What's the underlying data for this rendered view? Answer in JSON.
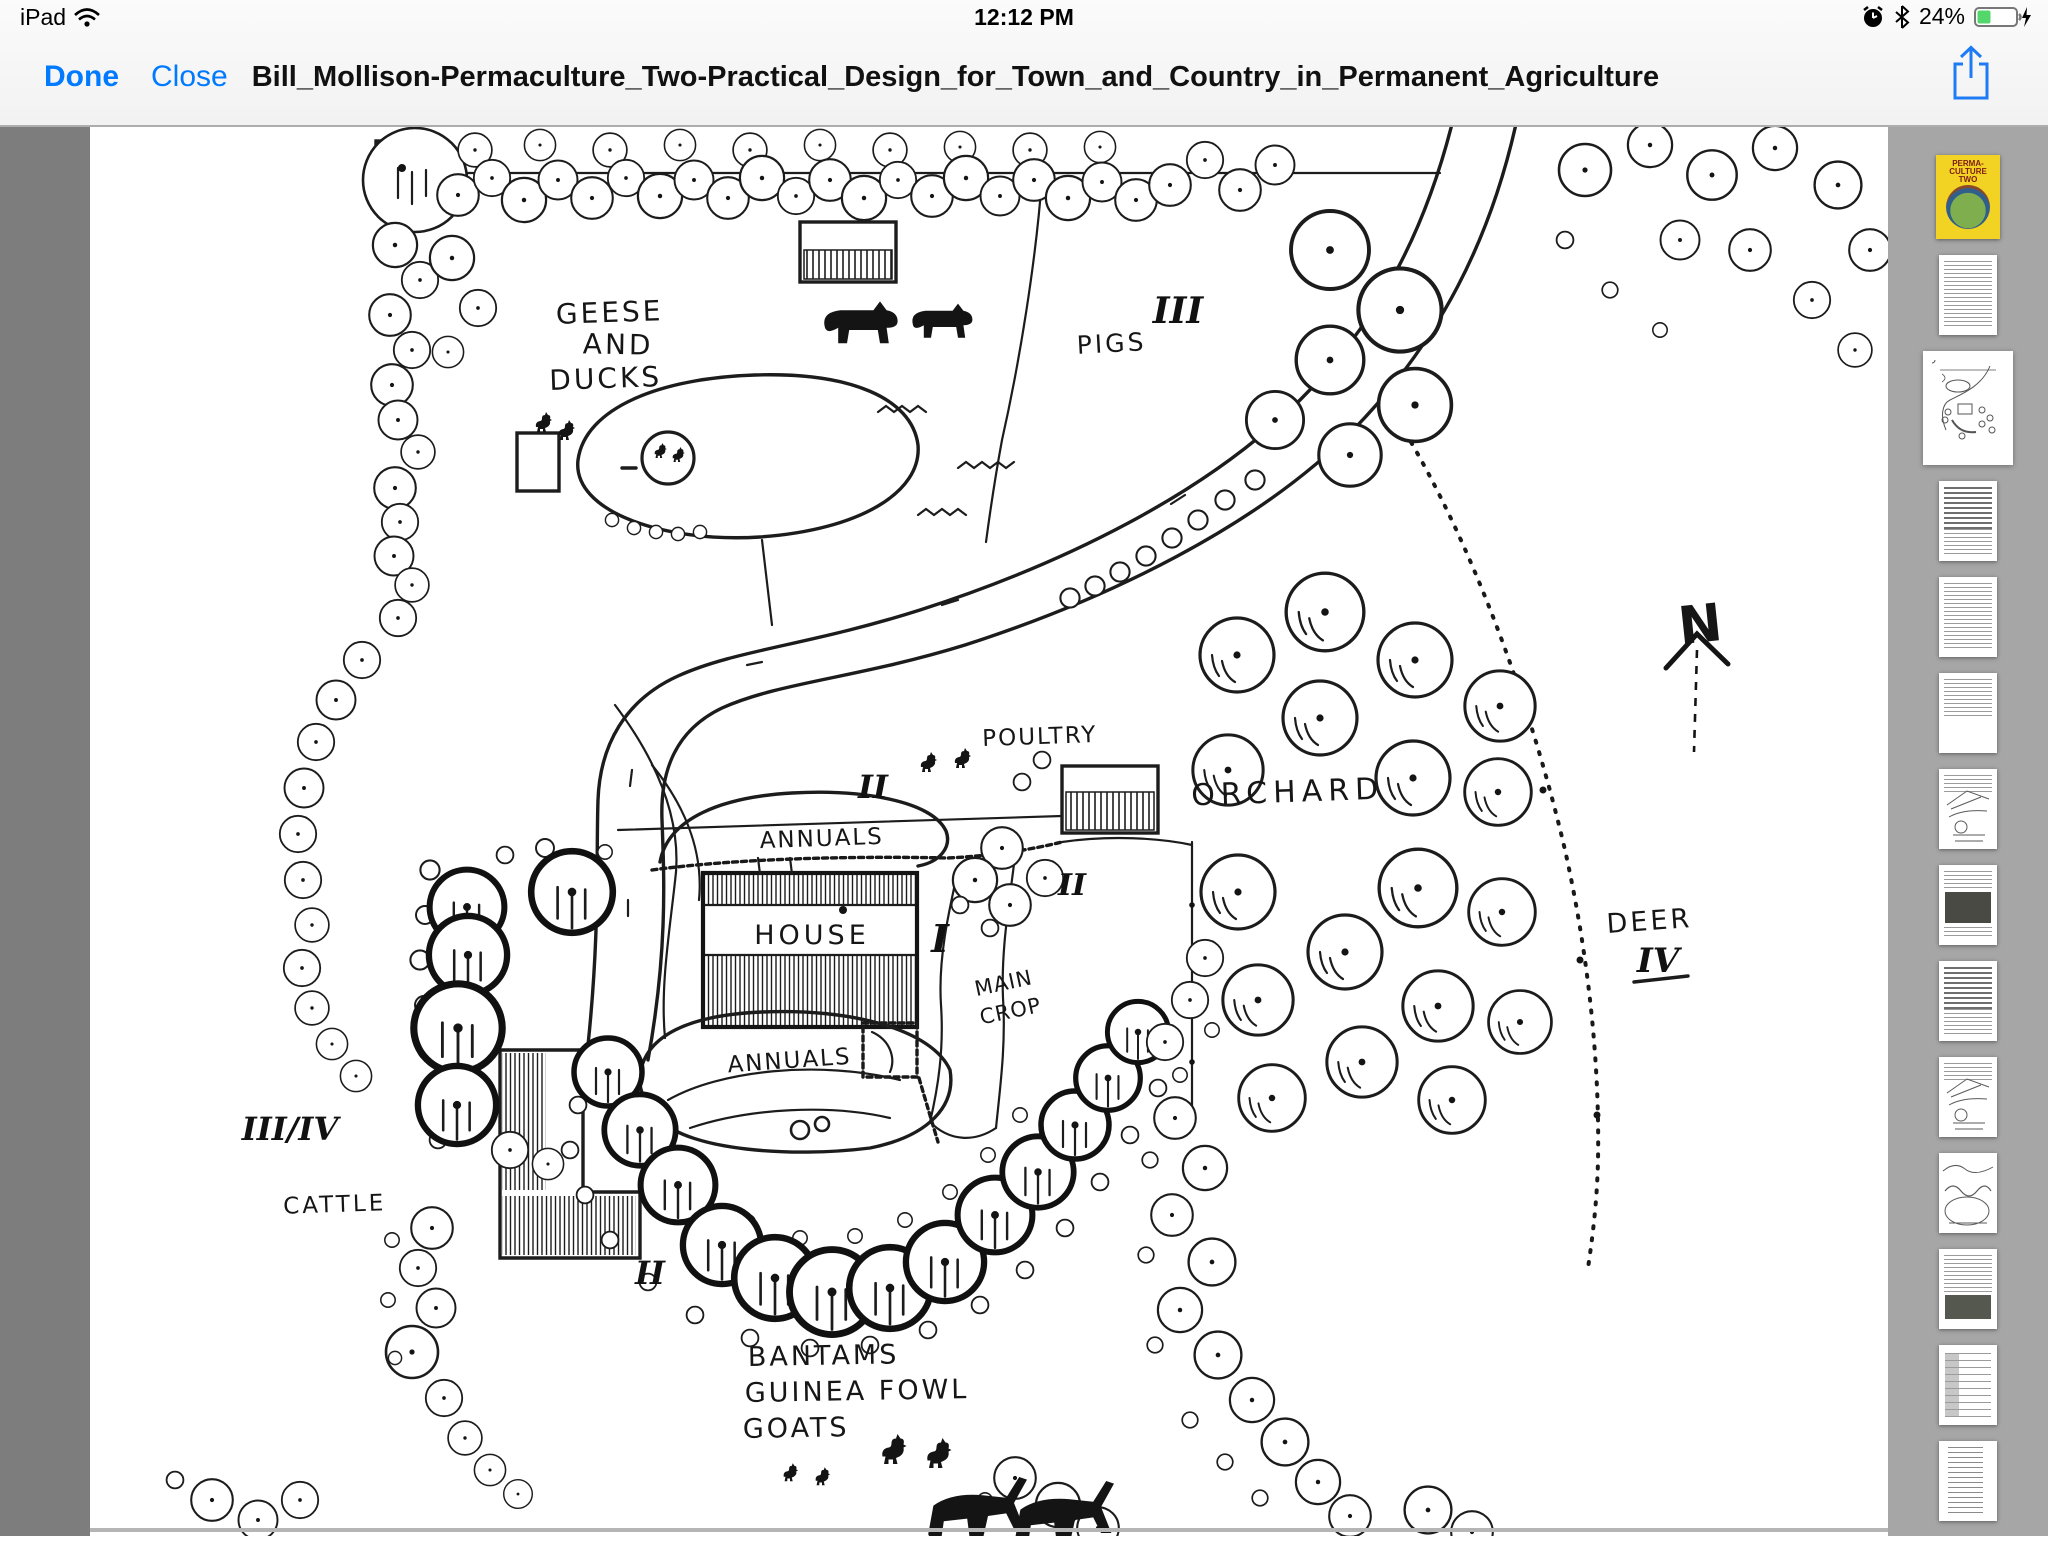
{
  "status_bar": {
    "device_label": "iPad",
    "time": "12:12 PM",
    "battery_percent": "24%",
    "battery_color": "#53d76a",
    "icons": [
      "wifi-icon",
      "alarm-clock-icon",
      "bluetooth-icon",
      "battery-icon",
      "charging-bolt-icon"
    ]
  },
  "toolbar": {
    "done_label": "Done",
    "close_label": "Close",
    "document_title": "Bill_Mollison-Permaculture_Two-Practical_Design_for_Town_and_Country_in_Permanent_Agriculture",
    "accent_color": "#007aff"
  },
  "sidebar": {
    "cover_title_lines": [
      "PERMA-",
      "CULTURE",
      "TWO"
    ],
    "thumbnails": [
      {
        "type": "cover",
        "selected": false
      },
      {
        "type": "text",
        "selected": false
      },
      {
        "type": "map",
        "selected": true
      },
      {
        "type": "text-dense",
        "selected": false
      },
      {
        "type": "text",
        "selected": false
      },
      {
        "type": "text-short",
        "selected": false
      },
      {
        "type": "diagram",
        "selected": false
      },
      {
        "type": "image",
        "selected": false
      },
      {
        "type": "text-dense",
        "selected": false
      },
      {
        "type": "diagram",
        "selected": false
      },
      {
        "type": "landscape",
        "selected": false
      },
      {
        "type": "text-image",
        "selected": false
      },
      {
        "type": "form",
        "selected": false
      },
      {
        "type": "list",
        "selected": false
      }
    ]
  },
  "page": {
    "labels": {
      "geese1": "GEESE",
      "geese2": "AND",
      "geese3": "DUCKS",
      "pigs": "PIGS",
      "poultry": "POULTRY",
      "orchard": "ORCHARD",
      "house": "HOUSE",
      "annuals_upper": "ANNUALS",
      "annuals_lower": "ANNUALS",
      "main_crop1": "MAIN",
      "main_crop2": "CROP",
      "cattle": "CATTLE",
      "bantams1": "BANTAMS",
      "bantams2": "GUINEA FOWL",
      "bantams3": "GOATS",
      "deer": "DEER",
      "north": "N"
    },
    "zones": {
      "i": "I",
      "ii": "II",
      "iii": "III",
      "iv": "IV",
      "iii_iv": "III/IV"
    }
  }
}
